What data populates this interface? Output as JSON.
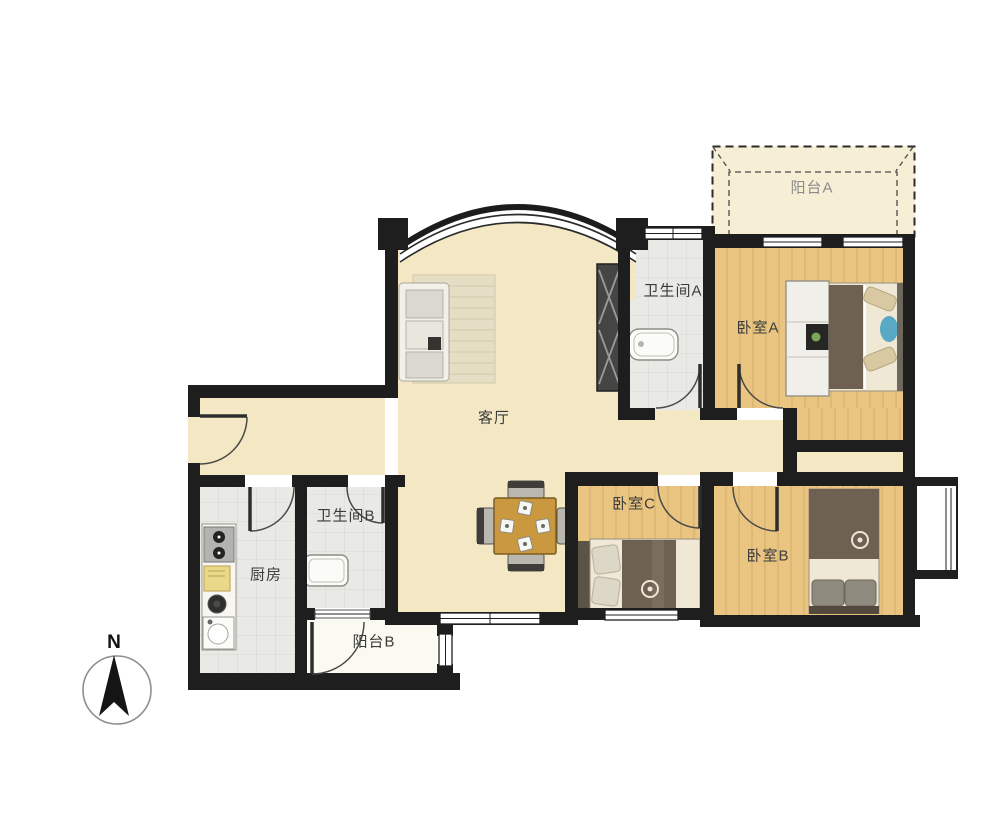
{
  "palette": {
    "wall": "#1e1e1e",
    "living_floor": "#f3e8c3",
    "wood_floor": "#eac581",
    "tile_floor": "#e9e9e5",
    "balcony_a_floor": "#f6efd6",
    "balcony_b_floor": "#fbfaf1",
    "label_color": "#3b3b3b",
    "balcony_a_label_color": "#8a8a8a",
    "door_arc_color": "#555555",
    "furniture_wood": "#c9983f",
    "bed_blanket": "#6f6152"
  },
  "rooms": {
    "living": {
      "label": "客厅"
    },
    "bedroom_a": {
      "label": "卧室A"
    },
    "bedroom_b": {
      "label": "卧室B"
    },
    "bedroom_c": {
      "label": "卧室C"
    },
    "bathroom_a": {
      "label": "卫生间A"
    },
    "bathroom_b": {
      "label": "卫生间B"
    },
    "kitchen": {
      "label": "厨房"
    },
    "balcony_a": {
      "label": "阳台A"
    },
    "balcony_b": {
      "label": "阳台B"
    }
  },
  "compass": {
    "north_label": "N"
  }
}
